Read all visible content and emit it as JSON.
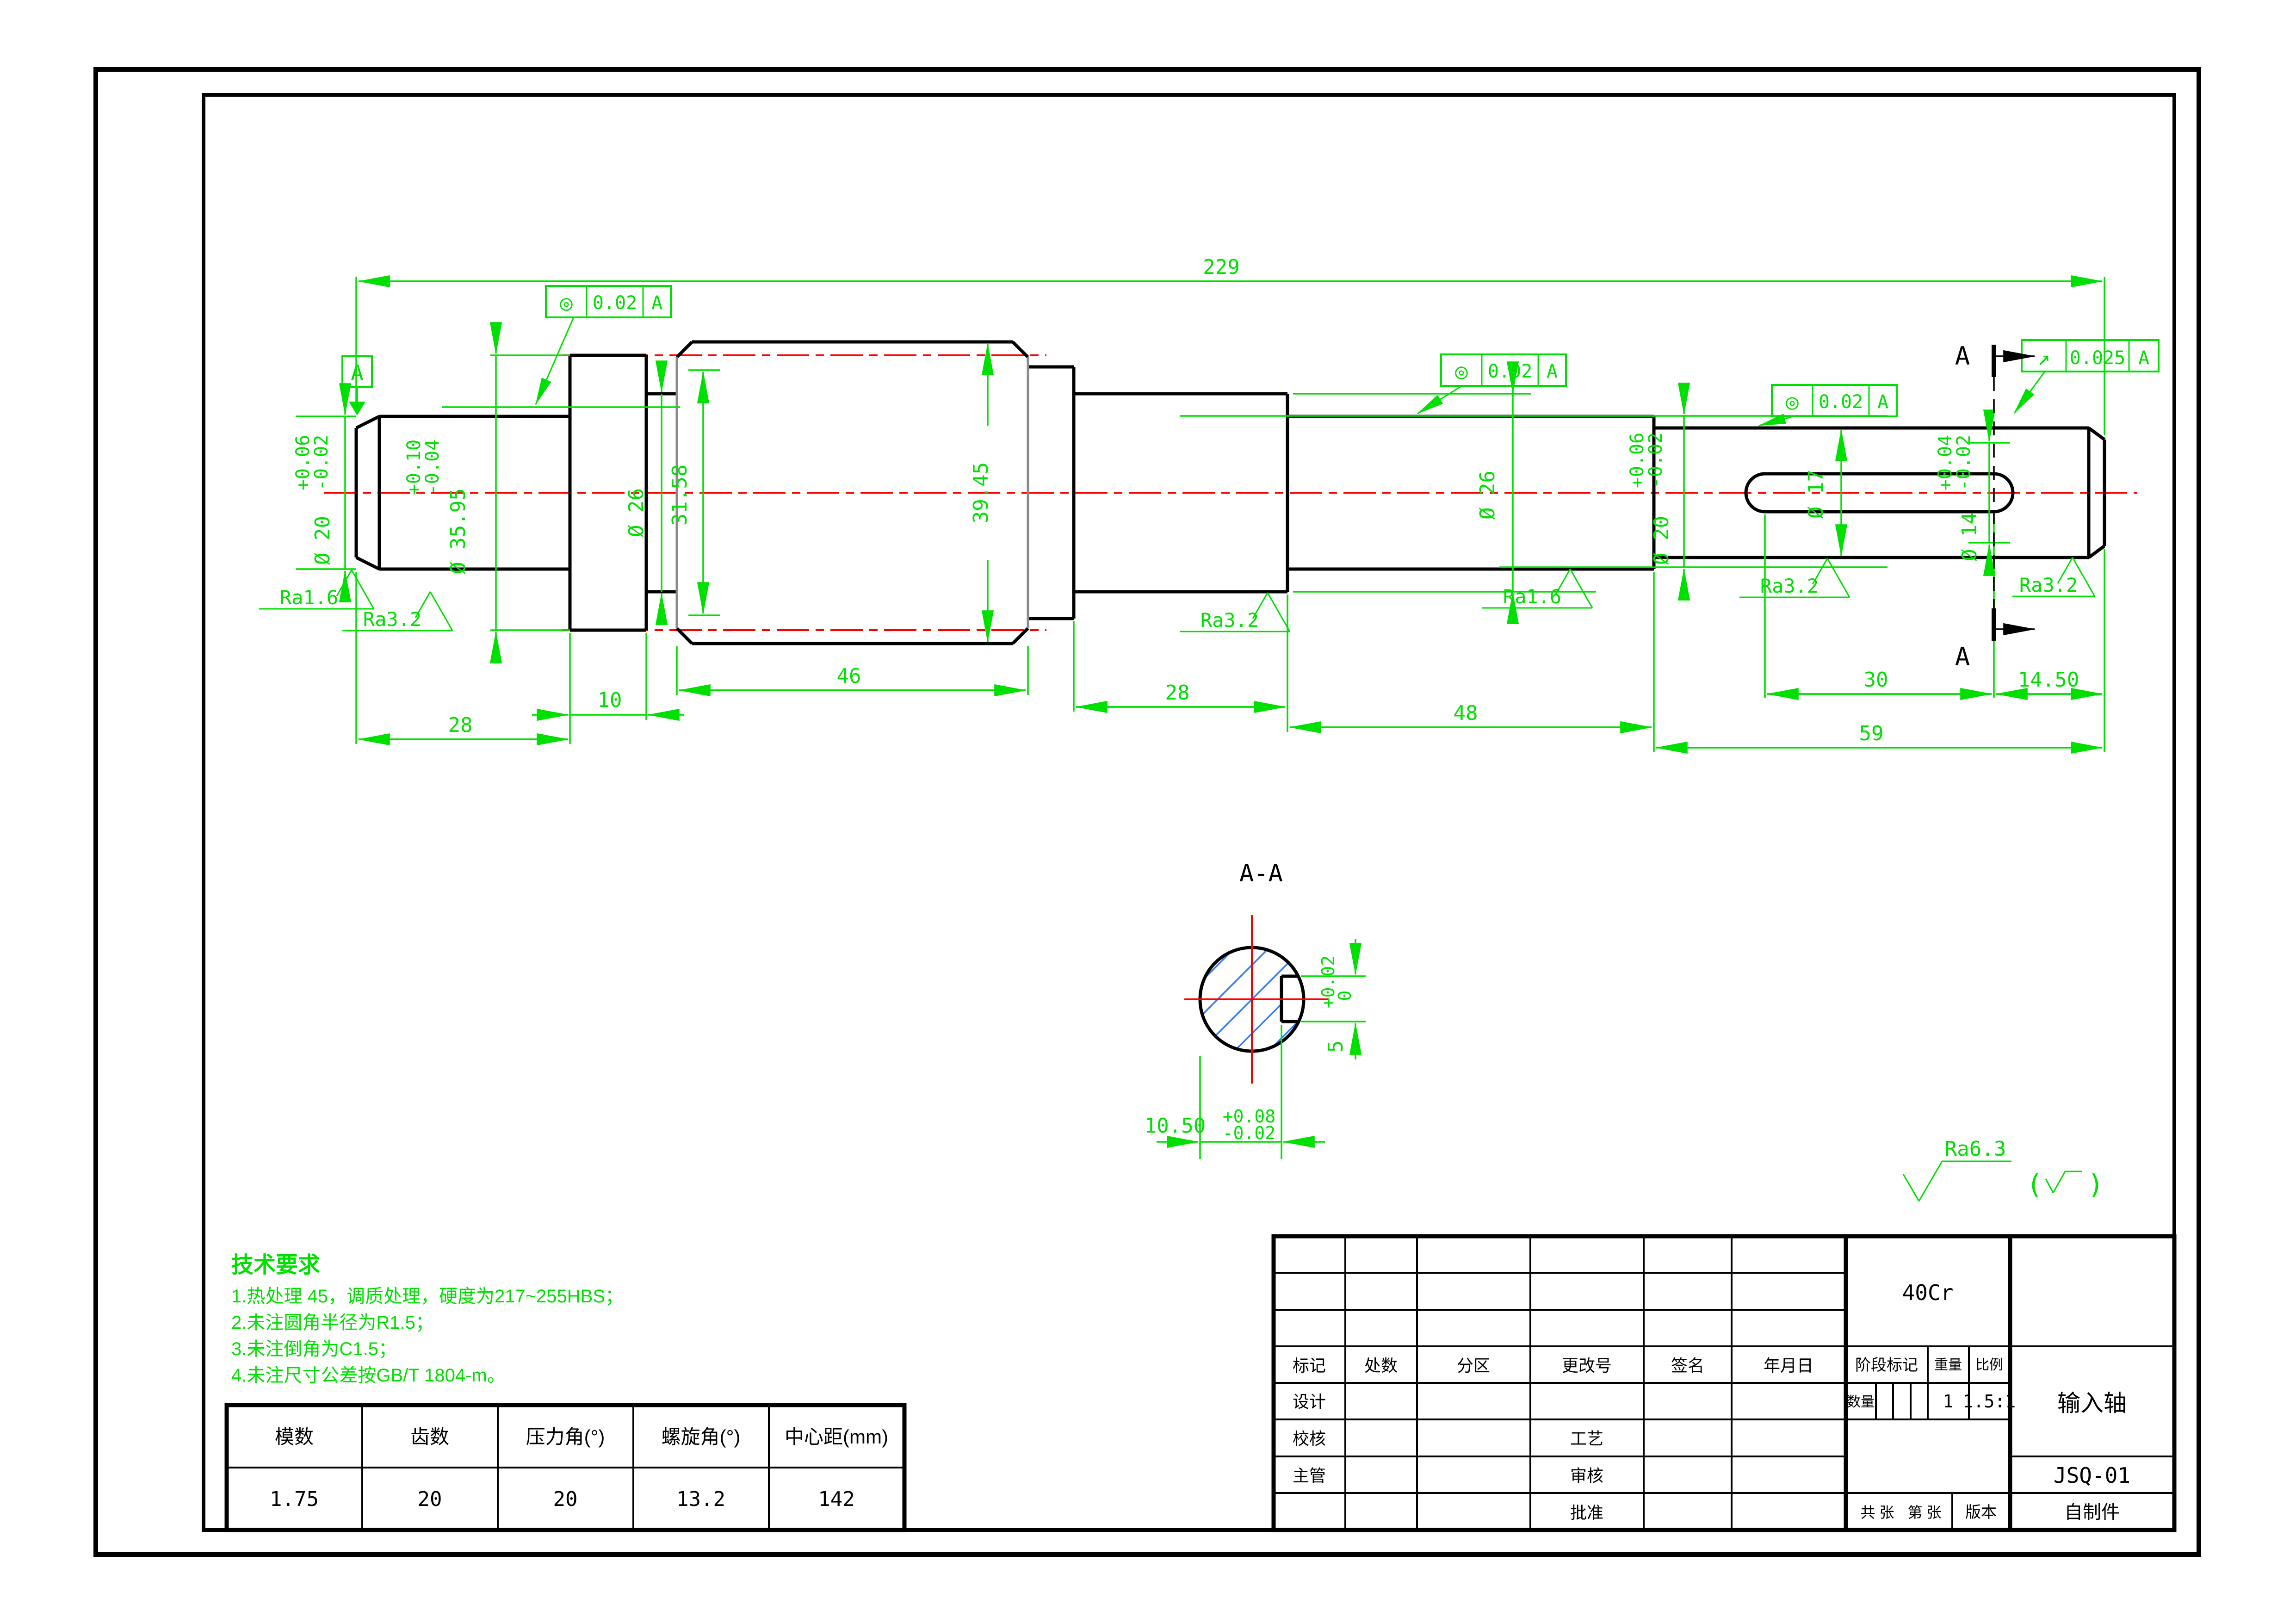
{
  "dims": {
    "total": "229",
    "seg_a": "28",
    "seg_b": "10",
    "seg_gear": "46",
    "seg_f": "28",
    "seg_g": "48",
    "seg_i": "59",
    "key_len": "30",
    "key_end": "14.50",
    "d20_left": {
      "plus": "+0.06",
      "minus": "-0.02",
      "dia": "Ø 20"
    },
    "d35_95": {
      "plus": "+0.10",
      "minus": "-0.04",
      "dia": "Ø 35.95"
    },
    "d26_relief": "Ø 26",
    "root_dia": "31.58",
    "gear_od": "39.45",
    "d26_mid": "Ø 26",
    "d20_right": {
      "plus": "+0.06",
      "minus": "-0.02",
      "dia": "Ø 20"
    },
    "d17": "Ø 17",
    "d14": {
      "plus": "+0.04",
      "minus": "-0.02",
      "dia": "Ø 14"
    }
  },
  "section_view": {
    "title": "A-A",
    "offset": "10.50",
    "offset_plus": "+0.08",
    "offset_minus": "-0.02",
    "key_width": "5",
    "key_width_plus": "+0.02",
    "key_width_minus": "0"
  },
  "datum": {
    "label": "A"
  },
  "cut": {
    "top": "A",
    "bottom": "A"
  },
  "tolerances": {
    "t1": {
      "symbol": "◎",
      "value": "0.02",
      "datum": "A"
    },
    "t2": {
      "symbol": "◎",
      "value": "0.02",
      "datum": "A"
    },
    "t3": {
      "symbol": "◎",
      "value": "0.02",
      "datum": "A"
    },
    "t4": {
      "symbol": "↗",
      "value": "0.025",
      "datum": "A"
    }
  },
  "roughness": {
    "r1": "Ra1.6",
    "r2": "Ra3.2",
    "r3": "Ra3.2",
    "r4": "Ra1.6",
    "r5": "Ra3.2",
    "r6": "Ra3.2",
    "general": "Ra6.3",
    "paren_open": "(",
    "paren_close": ")"
  },
  "tech_req": {
    "title": "技术要求",
    "items": [
      "1.热处理 45，调质处理，硬度为217~255HBS；",
      "2.未注圆角半径为R1.5；",
      "3.未注倒角为C1.5；",
      "4.未注尺寸公差按GB/T 1804-m。"
    ]
  },
  "gear_table": {
    "headers": [
      "模数",
      "齿数",
      "压力角(°)",
      "螺旋角(°)",
      "中心距(mm)"
    ],
    "values": [
      "1.75",
      "20",
      "20",
      "13.2",
      "142"
    ]
  },
  "title_block": {
    "labels": {
      "mark": "标记",
      "count": "处数",
      "zone": "分区",
      "change_no": "更改号",
      "signature": "签名",
      "date": "年月日",
      "design": "设计",
      "check": "校核",
      "chief": "主管",
      "process": "工艺",
      "audit": "审核",
      "approve": "批准",
      "stage": "阶段标记",
      "weight": "重量",
      "scale": "比例",
      "quantity": "数量",
      "sheets": "共 张",
      "sheet_no": "第 张",
      "version": "版本"
    },
    "values": {
      "material": "40Cr",
      "part_name": "输入轴",
      "drawing_no": "JSQ-01",
      "source": "自制件",
      "weight": "1",
      "scale": "1.5:1"
    }
  }
}
